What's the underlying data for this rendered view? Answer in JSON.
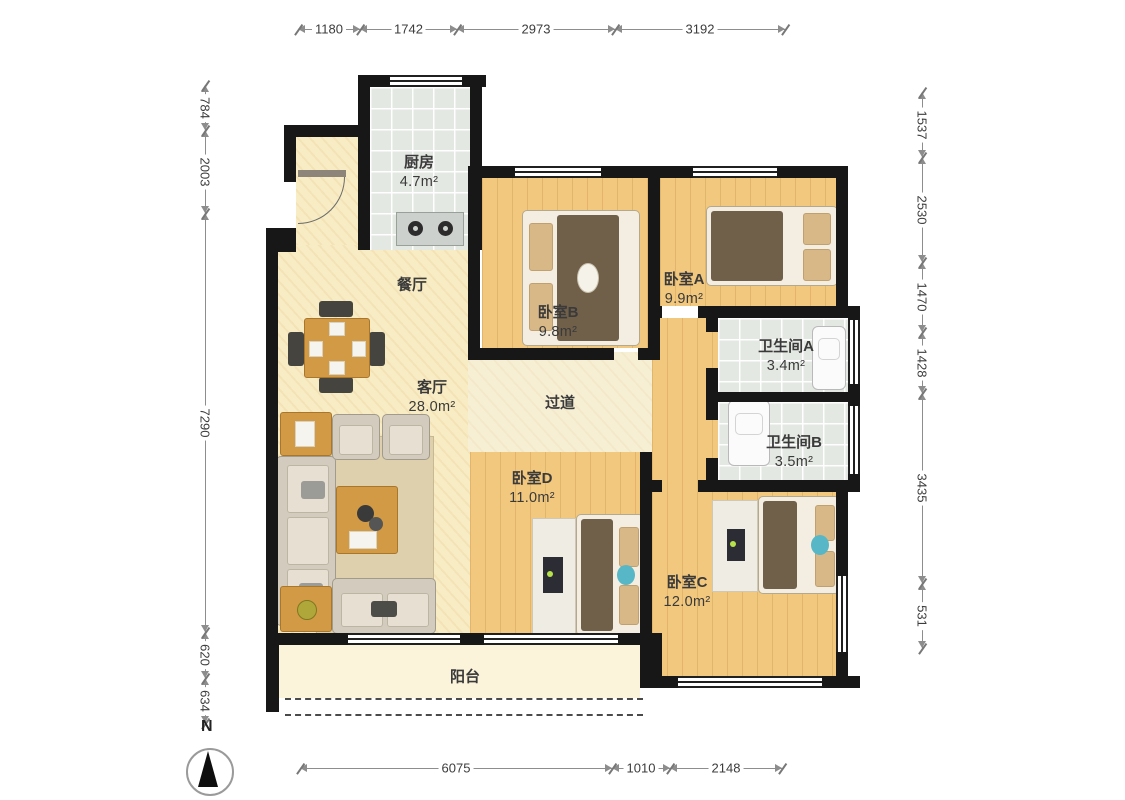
{
  "compass": {
    "label": "N"
  },
  "rooms": {
    "kitchen": {
      "name": "厨房",
      "area": "4.7m²"
    },
    "dining": {
      "name": "餐厅"
    },
    "living": {
      "name": "客厅",
      "area": "28.0m²"
    },
    "hallway": {
      "name": "过道"
    },
    "bedroom_a": {
      "name": "卧室A",
      "area": "9.9m²"
    },
    "bedroom_b": {
      "name": "卧室B",
      "area": "9.8m²"
    },
    "bedroom_c": {
      "name": "卧室C",
      "area": "12.0m²"
    },
    "bedroom_d": {
      "name": "卧室D",
      "area": "11.0m²"
    },
    "bathroom_a": {
      "name": "卫生间A",
      "area": "3.4m²"
    },
    "bathroom_b": {
      "name": "卫生间B",
      "area": "3.5m²"
    },
    "balcony": {
      "name": "阳台"
    }
  },
  "dimensions": {
    "top": [
      "1180",
      "1742",
      "2973",
      "3192"
    ],
    "bottom": [
      "6075",
      "1010",
      "2148"
    ],
    "left": [
      "784",
      "2003",
      "7290",
      "620",
      "634"
    ],
    "right": [
      "1537",
      "2530",
      "1470",
      "1428",
      "3435",
      "531"
    ]
  },
  "colors": {
    "wall": "#171717",
    "wood_floor": "#f1c87e",
    "tile_floor": "#e4e8e2",
    "living_floor": "#f8ecc4",
    "balcony_floor": "#fbf4da",
    "accent_teal": "#58b7c6",
    "blanket_brown": "#70604a",
    "table_wood": "#d29a45"
  }
}
